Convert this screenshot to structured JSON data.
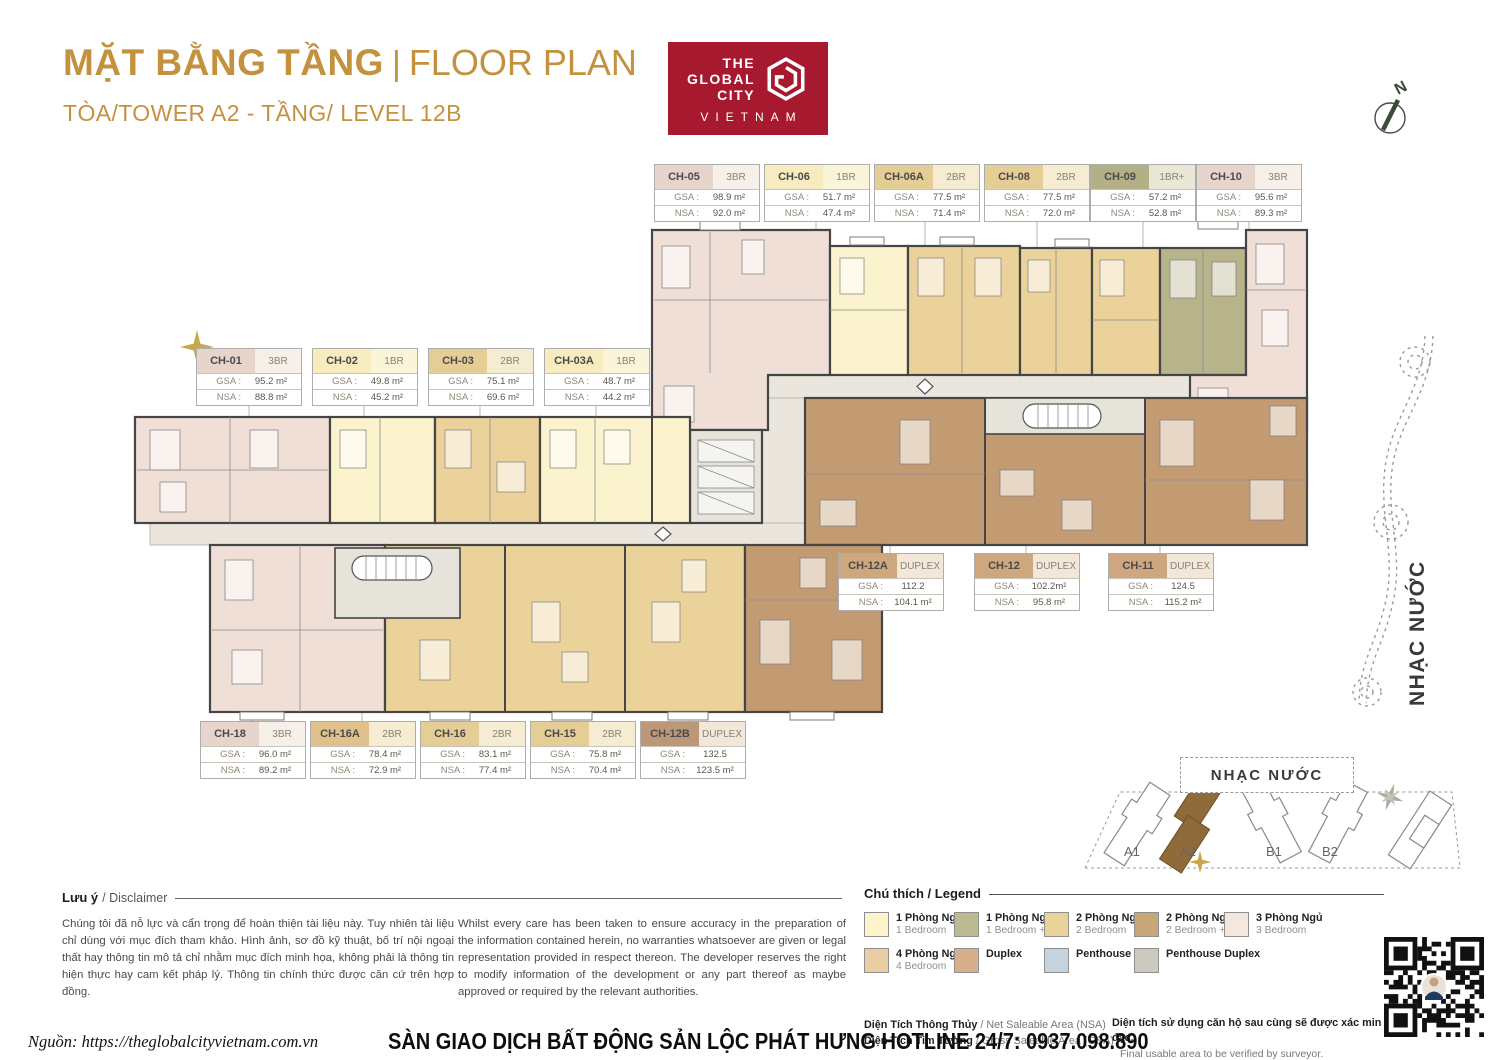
{
  "page": {
    "title_vn": "MẶT BẰNG TẦNG",
    "title_sep": "|",
    "title_en": "FLOOR PLAN",
    "subtitle": "TÒA/TOWER A2 - TẦNG/ LEVEL 12B",
    "accent_color": "#C4913F"
  },
  "logo": {
    "line1": "THE",
    "line2": "GLOBAL",
    "line3": "CITY",
    "bottom": "VIETNAM",
    "bg_color": "#A6192E"
  },
  "compass": {
    "label": "N"
  },
  "unit_labels": {
    "gsa": "GSA :",
    "nsa": "NSA :"
  },
  "unit_cards": [
    {
      "id": "CH-05",
      "type": "3BR",
      "gsa": "98.9 m²",
      "nsa": "92.0 m²",
      "color": "#E7D5CC",
      "type_color": "#F7F0E9",
      "x": 654,
      "y": 164
    },
    {
      "id": "CH-06",
      "type": "1BR",
      "gsa": "51.7 m²",
      "nsa": "47.4 m²",
      "color": "#F6ECC0",
      "type_color": "#FAF4D9",
      "x": 764,
      "y": 164
    },
    {
      "id": "CH-06A",
      "type": "2BR",
      "gsa": "77.5 m²",
      "nsa": "71.4 m²",
      "color": "#E5CD96",
      "type_color": "#F5ECD2",
      "x": 874,
      "y": 164
    },
    {
      "id": "CH-08",
      "type": "2BR",
      "gsa": "77.5 m²",
      "nsa": "72.0 m²",
      "color": "#E5CD96",
      "type_color": "#F5ECD2",
      "x": 984,
      "y": 164
    },
    {
      "id": "CH-09",
      "type": "1BR+",
      "gsa": "57.2 m²",
      "nsa": "52.8 m²",
      "color": "#B3B088",
      "type_color": "#E9E8D6",
      "x": 1090,
      "y": 164
    },
    {
      "id": "CH-10",
      "type": "3BR",
      "gsa": "95.6 m²",
      "nsa": "89.3 m²",
      "color": "#E7D5CC",
      "type_color": "#F7F0E9",
      "x": 1196,
      "y": 164
    },
    {
      "id": "CH-01",
      "type": "3BR",
      "gsa": "95.2 m²",
      "nsa": "88.8 m²",
      "color": "#E7D5CC",
      "type_color": "#F7F0E9",
      "x": 196,
      "y": 348
    },
    {
      "id": "CH-02",
      "type": "1BR",
      "gsa": "49.8 m²",
      "nsa": "45.2 m²",
      "color": "#F6ECC0",
      "type_color": "#FAF4D9",
      "x": 312,
      "y": 348
    },
    {
      "id": "CH-03",
      "type": "2BR",
      "gsa": "75.1 m²",
      "nsa": "69.6 m²",
      "color": "#E5CD96",
      "type_color": "#F5ECD2",
      "x": 428,
      "y": 348
    },
    {
      "id": "CH-03A",
      "type": "1BR",
      "gsa": "48.7 m²",
      "nsa": "44.2 m²",
      "color": "#F6ECC0",
      "type_color": "#FAF4D9",
      "x": 544,
      "y": 348
    },
    {
      "id": "CH-12A",
      "type": "DUPLEX",
      "gsa": "112.2",
      "nsa": "104.1 m²",
      "color": "#CFA77F",
      "type_color": "#F2E7D8",
      "x": 838,
      "y": 553
    },
    {
      "id": "CH-12",
      "type": "DUPLEX",
      "gsa": "102.2m²",
      "nsa": "95.8 m²",
      "color": "#CFA77F",
      "type_color": "#F2E7D8",
      "x": 974,
      "y": 553
    },
    {
      "id": "CH-11",
      "type": "DUPLEX",
      "gsa": "124.5",
      "nsa": "115.2 m²",
      "color": "#CFA77F",
      "type_color": "#F2E7D8",
      "x": 1108,
      "y": 553
    },
    {
      "id": "CH-18",
      "type": "3BR",
      "gsa": "96.0 m²",
      "nsa": "89.2 m²",
      "color": "#E7D5CC",
      "type_color": "#F7F0E9",
      "x": 200,
      "y": 721
    },
    {
      "id": "CH-16A",
      "type": "2BR",
      "gsa": "78.4 m²",
      "nsa": "72.9 m²",
      "color": "#E0C18B",
      "type_color": "#F5ECD2",
      "x": 310,
      "y": 721
    },
    {
      "id": "CH-16",
      "type": "2BR",
      "gsa": "83.1 m²",
      "nsa": "77.4 m²",
      "color": "#E5CD96",
      "type_color": "#F5ECD2",
      "x": 420,
      "y": 721
    },
    {
      "id": "CH-15",
      "type": "2BR",
      "gsa": "75.8 m²",
      "nsa": "70.4 m²",
      "color": "#E5CD96",
      "type_color": "#F5ECD2",
      "x": 530,
      "y": 721
    },
    {
      "id": "CH-12B",
      "type": "DUPLEX",
      "gsa": "132.5",
      "nsa": "123.5 m²",
      "color": "#BD9877",
      "type_color": "#F2E7D8",
      "x": 640,
      "y": 721
    }
  ],
  "legend": {
    "title": "Chú thích / Legend",
    "row1": [
      {
        "vn": "1 Phòng Ngủ",
        "en": "1 Bedroom",
        "color": "#FCF4CB"
      },
      {
        "vn": "1 Phòng Ngủ +",
        "en": "1 Bedroom +",
        "color": "#BCBA90"
      },
      {
        "vn": "2 Phòng Ngủ",
        "en": "2 Bedroom",
        "color": "#EAD29B"
      },
      {
        "vn": "2 Phòng Ngủ +",
        "en": "2 Bedroom +",
        "color": "#C7A677"
      },
      {
        "vn": "3 Phòng Ngủ",
        "en": "3 Bedroom",
        "color": "#F4E8DE"
      }
    ],
    "row2": [
      {
        "vn": "4 Phòng Ngủ",
        "en": "4 Bedroom",
        "color": "#EBCDA3"
      },
      {
        "vn": "Duplex",
        "en": "",
        "color": "#D7AF8C"
      },
      {
        "vn": "Penthouse",
        "en": "",
        "color": "#C4D3DD"
      },
      {
        "vn": "Penthouse Duplex",
        "en": "",
        "color": "#CCC9C1"
      }
    ]
  },
  "disclaimer": {
    "title_vn": "Lưu ý",
    "title_en": "/ Disclaimer",
    "text_vn": "Chúng tôi đã nỗ lực và cẩn trọng để hoàn thiện tài liệu này. Tuy nhiên tài liệu chỉ dùng với mục đích tham khảo. Hình ảnh, sơ đồ kỹ thuật, bố trí nội ngoại thất hay thông tin mô tả chỉ nhằm mục đích minh họa, không phải là thông tin hiện thực hay cam kết pháp lý. Thông tin chính thức được căn cứ trên hợp đồng.",
    "text_en": "Whilst every care has been taken to ensure accuracy in the preparation of the information contained herein, no warranties whatsoever are given or legal representation provided in respect thereon. The developer reserves the right to modify information of the development or any part thereof as maybe approved or required by the relevant authorities."
  },
  "area_notes": {
    "nsa_vn": "Diện Tích Thông Thủy",
    "nsa_en": " / Net Saleable Area (NSA)",
    "gsa_vn": "Diện Tích Tim Tường",
    "gsa_en": " / Gross Saleable Area (GSA)",
    "verify_vn": "Diện tích sử dụng căn hộ sau cùng sẽ được xác minh l",
    "verify_vn2": "đạc.",
    "verify_en": "Final usable area to be verified by surveyor."
  },
  "footer": {
    "source": "Nguồn: https://theglobalcityvietnam.com.vn",
    "agency": "SÀN GIAO DỊCH BẤT ĐỘNG SẢN LỘC PHÁT HƯNG HOTLINE 24/7: 0937.098.890"
  },
  "site_plan": {
    "water_label": "NHẠC NƯỚC",
    "buildings": [
      "A1",
      "A2",
      "B1",
      "B2"
    ],
    "highlighted": "A2",
    "highlight_color": "#8F6B3C"
  },
  "right_water_text": "NHẠC NƯỚC",
  "plan_colors": {
    "one_br": "#FBF2CE",
    "one_br_plus": "#B7B48C",
    "two_br": "#EBD29B",
    "three_br": "#EFDFD6",
    "duplex": "#C29B73",
    "corridor": "#EAE6DD",
    "core": "#E6E3DA"
  }
}
